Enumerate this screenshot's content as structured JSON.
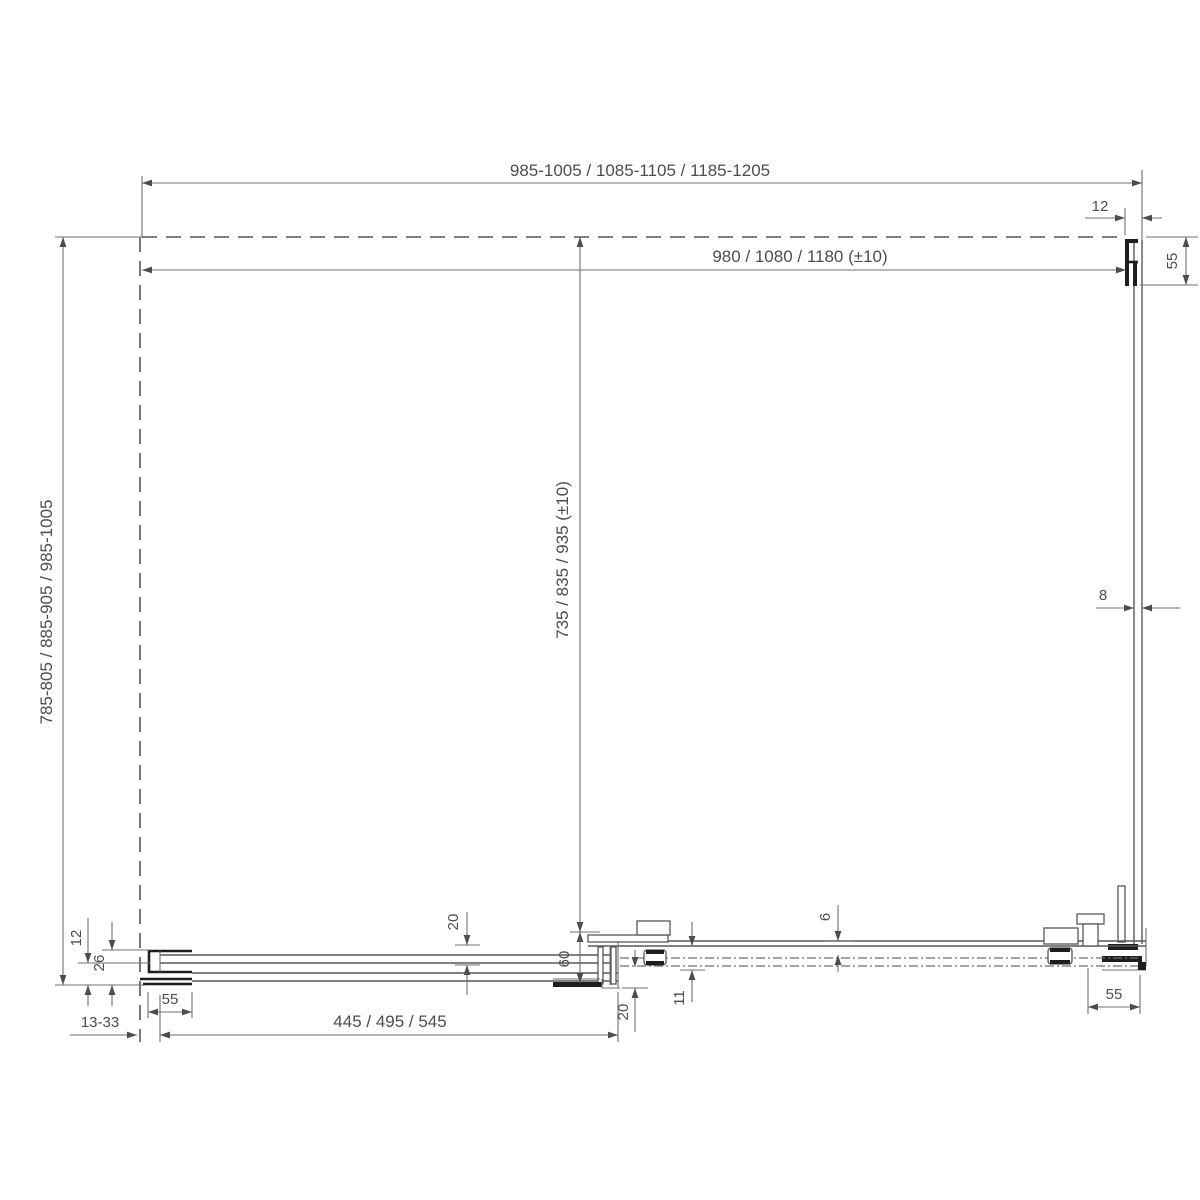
{
  "drawing": {
    "kind": "technical-dimension-drawing",
    "background": "#ffffff",
    "line_color": "#585858",
    "dim_line_color": "#6f6f6f",
    "profile_color": "#1e1e1e",
    "text_color": "#4d4d4d"
  },
  "dims": {
    "overall_width": "985-1005 / 1085-1105 / 1185-1205",
    "glass_width": "980 / 1080 / 1180 (±10)",
    "overall_depth": "785-805 / 885-905 / 985-1005",
    "inner_depth": "735 / 835 / 935 (±10)",
    "top_right_profile_width": "12",
    "top_right_profile_length": "55",
    "side_glass_thickness": "8",
    "bottom_left_glass_inset": "12",
    "bottom_left_profile_depth": "26",
    "bottom_left_profile_width": "55",
    "wall_adjustment_range": "13-33",
    "fixed_panel_length": "445 / 495 / 545",
    "panel_offset": "20",
    "rail_depth": "60",
    "endcap_width": "20",
    "door_gap": "6",
    "rail_inner_gap": "11",
    "bottom_right_profile_width": "55"
  }
}
